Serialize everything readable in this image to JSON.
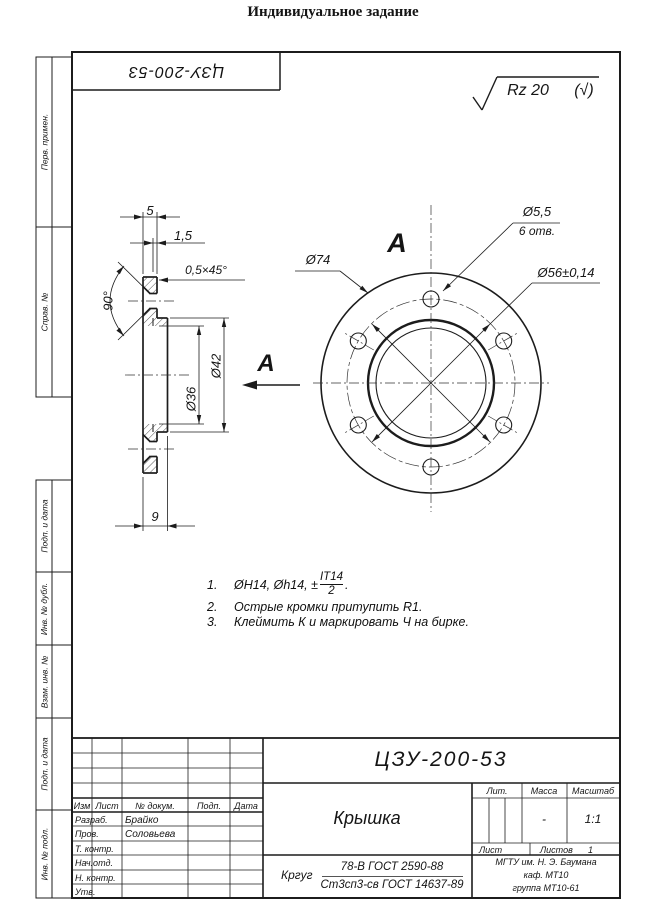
{
  "page": {
    "title": "Индивидуальное задание"
  },
  "stamp": {
    "doc_number_rotated": "ЦЗУ-200-53"
  },
  "roughness": {
    "value": "Rz 20",
    "bracket": "(√)"
  },
  "margin": {
    "items": [
      {
        "label": "Перв. примен."
      },
      {
        "label": "Справ. №"
      },
      {
        "label": "Подп. и дата"
      },
      {
        "label": "Инв. № дубл."
      },
      {
        "label": "Взам. инв. №"
      },
      {
        "label": "Подп. и дата"
      },
      {
        "label": "Инв. № подл."
      }
    ]
  },
  "section_view": {
    "view_label": "A",
    "dims": {
      "flange_thickness": "5",
      "step": "1,5",
      "chamfer": "0,5×45°",
      "countersink_angle": "90°",
      "d42": "Ø42",
      "d36": "Ø36",
      "total_thickness": "9"
    }
  },
  "circular_view": {
    "view_label": "A",
    "dims": {
      "outer": "Ø74",
      "hole": "Ø5,5",
      "hole_count": "6 отв.",
      "bolt_circle": "Ø56±0,14"
    }
  },
  "notes": {
    "n1": {
      "num": "1.",
      "before_frac": "ØH14, Øh14, ±",
      "frac_num": "IT14",
      "frac_den": "2",
      "after_frac": "."
    },
    "n2": {
      "num": "2.",
      "text": "Острые кромки притупить R1."
    },
    "n3": {
      "num": "3.",
      "text": "Клеймить К и маркировать Ч на бирке."
    }
  },
  "title_block": {
    "doc_number": "ЦЗУ-200-53",
    "part_name": "Крышка",
    "header": {
      "izm": "Изм",
      "list": "Лист",
      "doc": "№ докум.",
      "podp": "Подп.",
      "data": "Дата"
    },
    "rows": [
      {
        "label": "Разраб.",
        "value": "Брайко"
      },
      {
        "label": "Пров.",
        "value": "Соловьева"
      },
      {
        "label": "Т. контр.",
        "value": ""
      },
      {
        "label": "Нач.отд.",
        "value": ""
      },
      {
        "label": "Н. контр.",
        "value": ""
      },
      {
        "label": "Утв.",
        "value": ""
      }
    ],
    "lit_label": "Лит.",
    "mass_label": "Масса",
    "mass_value": "-",
    "scale_label": "Масштаб",
    "scale_value": "1:1",
    "sheet_label": "Лист",
    "sheets_label": "Листов",
    "sheets_value": "1",
    "material_prefix": "Кргуг",
    "material_top": "78-В ГОСТ 2590-88",
    "material_bottom": "Ст3сп3-св ГОСТ 14637-89",
    "org_line1": "МГТУ им. Н. Э. Баумана",
    "org_line2": "каф. МТ10",
    "org_line3": "группа МТ10-61"
  },
  "colors": {
    "line": "#1c1c1c",
    "paper": "#ffffff"
  }
}
